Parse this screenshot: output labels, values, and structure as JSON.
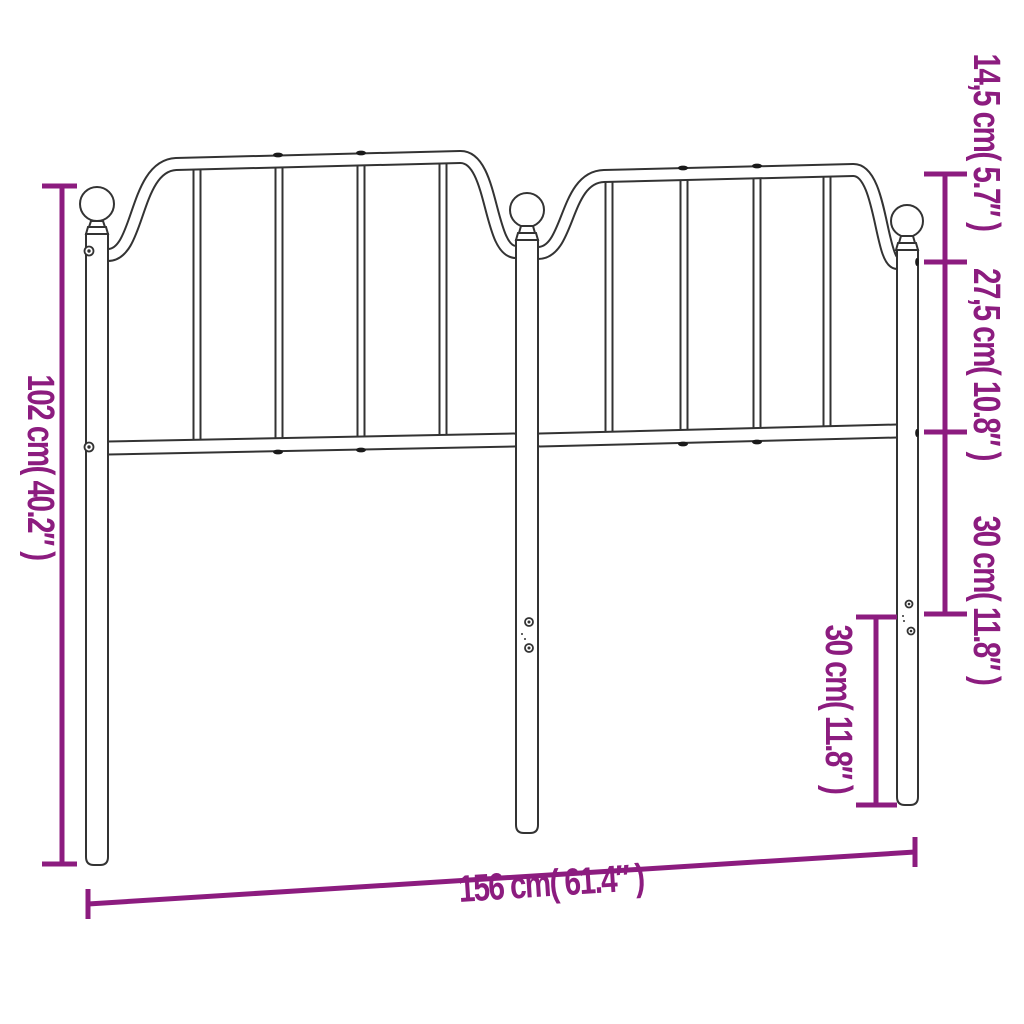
{
  "diagram": {
    "type": "product-dimension-diagram",
    "subject": "metal-headboard-line-drawing",
    "background": "#ffffff",
    "outline_color": "#333333",
    "accent_color": "#8C1C7F",
    "labels": {
      "height": "102 cm( 40.2″ )",
      "width": "156 cm( 61.4″ )",
      "finial_drop": "14,5 cm( 5.7″ )",
      "upper_panel": "27,5 cm( 10.8″ )",
      "lower_panel": "30 cm( 11.8″ )",
      "leg_extension": "30 cm( 11.8″ )"
    }
  }
}
